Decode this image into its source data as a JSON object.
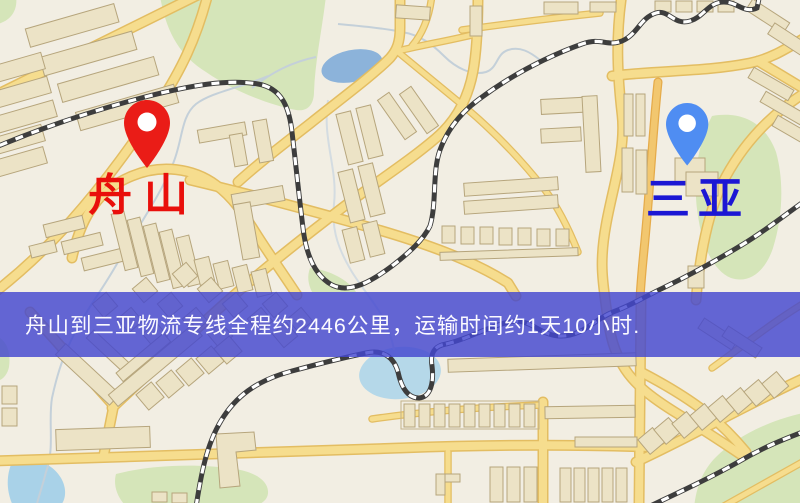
{
  "map": {
    "origin_marker": {
      "label": "舟山",
      "pin_color": "#ea1c17",
      "label_color": "#e90f0b",
      "icon": "location-pin"
    },
    "destination_marker": {
      "label": "三亚",
      "pin_color": "#4f8df2",
      "label_color": "#1c17d4",
      "icon": "location-pin"
    },
    "info_banner": {
      "text": "舟山到三亚物流专线全程约2446公里，运输时间约1天10小时.",
      "background_color": "rgba(67,71,208,0.82)",
      "text_color": "#fbfaff"
    },
    "route_facts": {
      "origin": "舟山",
      "destination": "三亚",
      "distance": "约2446公里",
      "duration": "约1天10小时"
    }
  },
  "map_palette": {
    "background": "#f2eee3",
    "road_fill": "#f6dd8e",
    "road_casing": "#e3bd62",
    "orange_road": "#f2c76f",
    "building_fill": "#ece3c6",
    "park_green": "#d5e5b9",
    "water_blue": "#a9d2e8",
    "pond_blue": "#8cb3da",
    "railway": "#3d3d3d"
  }
}
